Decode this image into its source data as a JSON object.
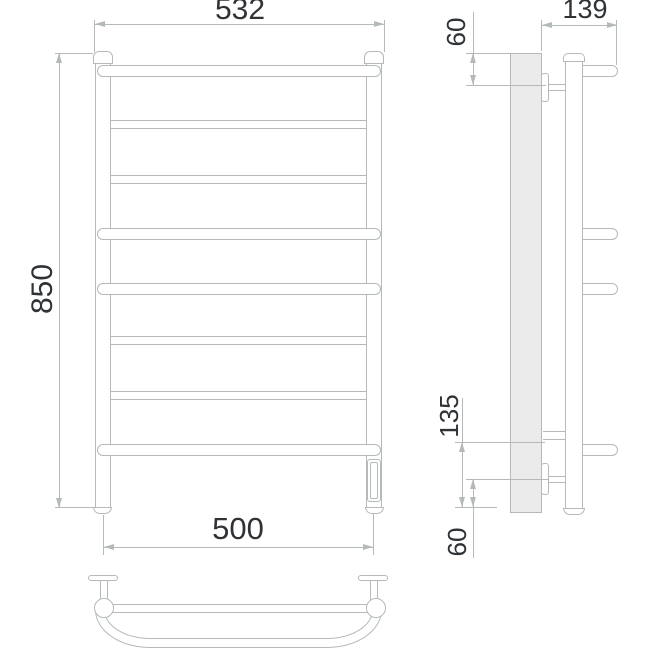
{
  "dimensions": {
    "front": {
      "overall_width_mm": "532",
      "overall_height_mm": "850",
      "connection_spacing_mm": "500"
    },
    "side": {
      "overall_depth_mm": "139",
      "top_bracket_offset_mm": "60",
      "bottom_bar_offset_mm": "135",
      "bottom_bracket_offset_mm": "60"
    }
  },
  "colors": {
    "line": "#b4babc",
    "text": "#2f3336",
    "wall_fill": "#ebebec",
    "background": "#ffffff"
  }
}
